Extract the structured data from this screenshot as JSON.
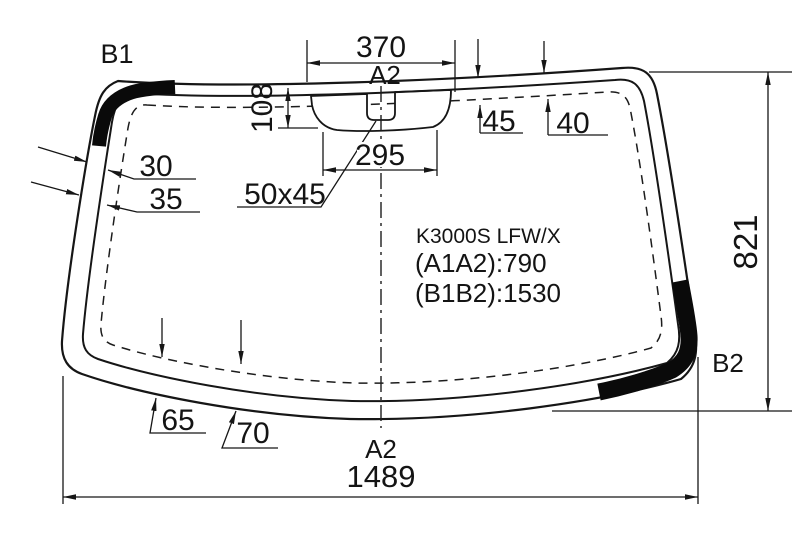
{
  "title": "Windshield glass technical drawing",
  "colors": {
    "line": "#161616",
    "background": "#ffffff",
    "band": "#0a0a0a"
  },
  "glass": {
    "model_label": "K3000S LFW/X",
    "a1a2_label": "(A1A2):790",
    "b1b2_label": "(B1B2):1530",
    "corner_top_left": "B1",
    "corner_bottom_right": "B2"
  },
  "dimensions": {
    "sensor_outer_width": "370",
    "centerline_ref_top": "A2",
    "band_depth": "108",
    "sensor_inner_width": "295",
    "notch_size": "50x45",
    "top_inset_left": "45",
    "top_inset_right": "40",
    "left_inset_upper": "30",
    "left_inset_lower": "35",
    "bottom_inset_left": "65",
    "bottom_inset_right": "70",
    "glass_height": "821",
    "glass_width": "1489",
    "centerline_ref_bottom": "A2"
  }
}
